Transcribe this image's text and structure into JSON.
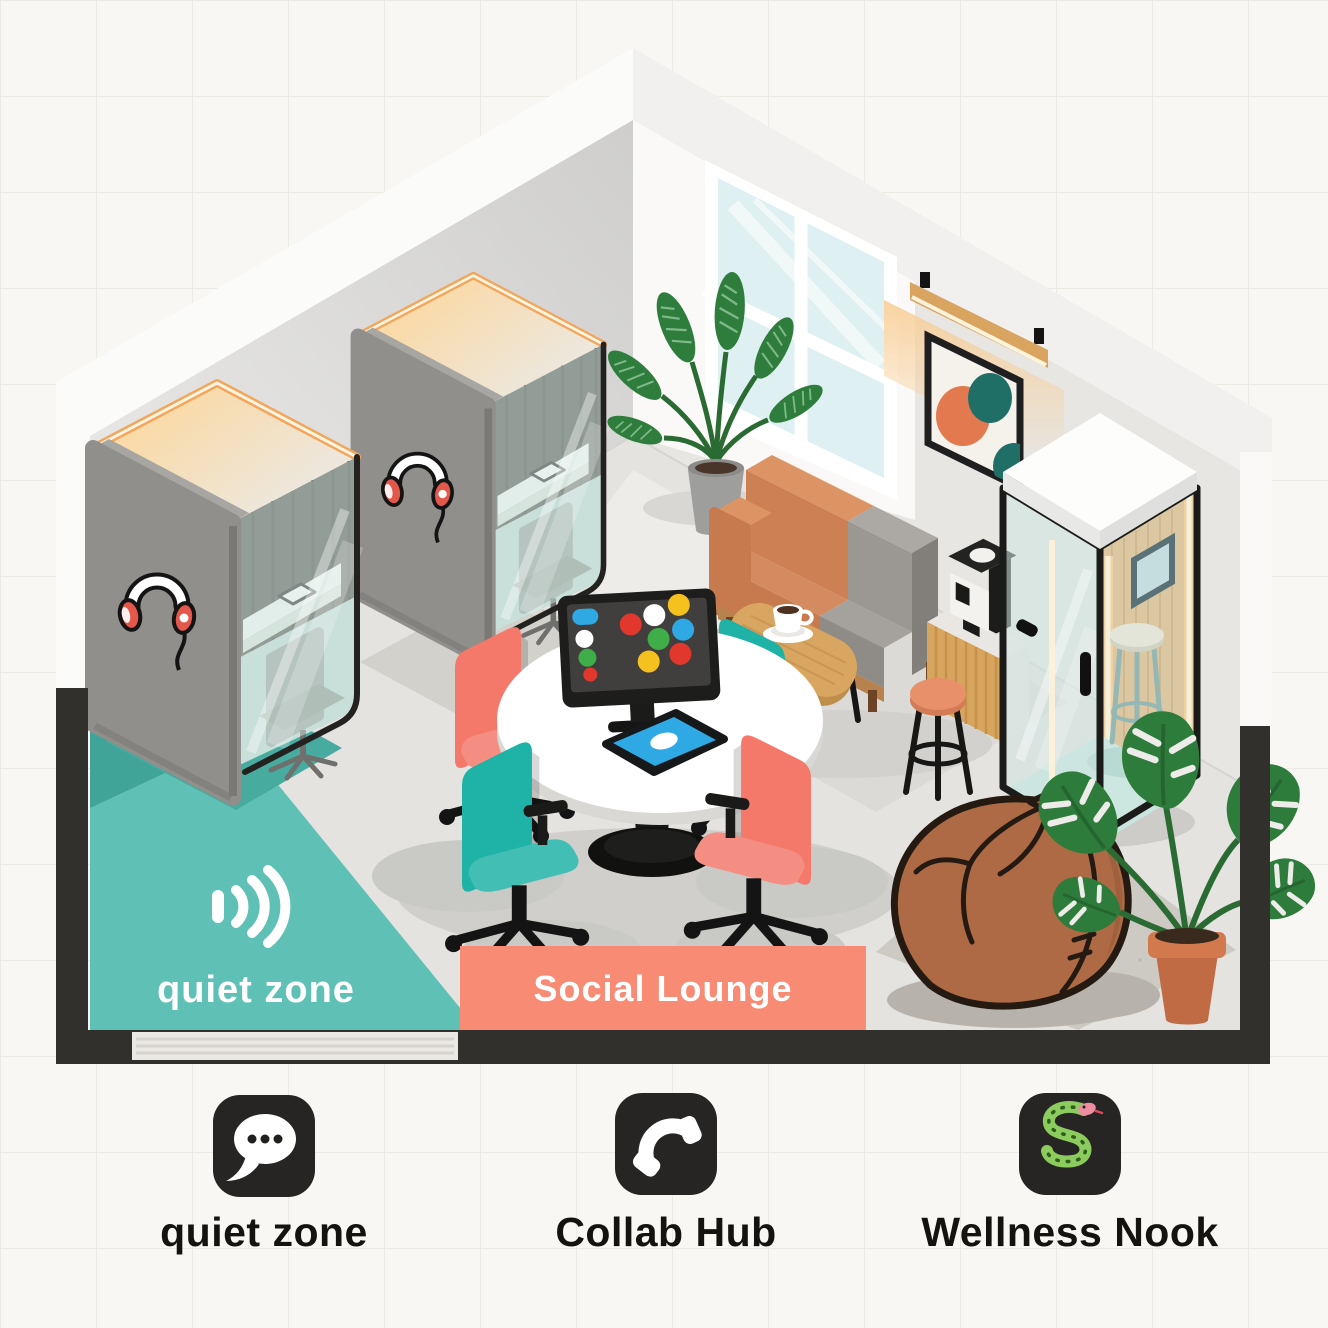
{
  "zones": {
    "quiet_zone": {
      "label": "quiet zone",
      "icon": "sound-waves-icon"
    },
    "social_lounge": {
      "label": "Social Lounge"
    }
  },
  "legend": {
    "items": [
      {
        "label": "quiet zone",
        "icon": "speech-bubble-icon"
      },
      {
        "label": "Collab Hub",
        "icon": "phone-handset-icon"
      },
      {
        "label": "Wellness Nook",
        "icon": "snake-icon"
      }
    ]
  },
  "colors": {
    "background": "#F8F7F3",
    "grid_line": "#ECEAE4",
    "quiet_zone_teal": "#5FC0B5",
    "quiet_zone_teal_dark": "#41A498",
    "social_lounge_coral": "#F88B74",
    "slab_dark": "#32302D",
    "legend_icon_bg": "#262523",
    "floor_gray": "#E4E3E0",
    "wall_gray": "#E7E6E3",
    "booth_gray": "#908F8B",
    "glass_teal": "#CFE5E0",
    "led_warm": "#F2A65C",
    "chair_coral": "#F4796B",
    "chair_teal": "#1FB2A6",
    "sofa_orange": "#CE8055",
    "sofa_gray": "#9B9792",
    "wood": "#D8A660",
    "beanbag_brown": "#AD6A44",
    "plant_green": "#2E7C3B",
    "tablet_blue": "#2FA9E4",
    "snake_green": "#8CCB5E",
    "headphone_red": "#E4584B"
  }
}
